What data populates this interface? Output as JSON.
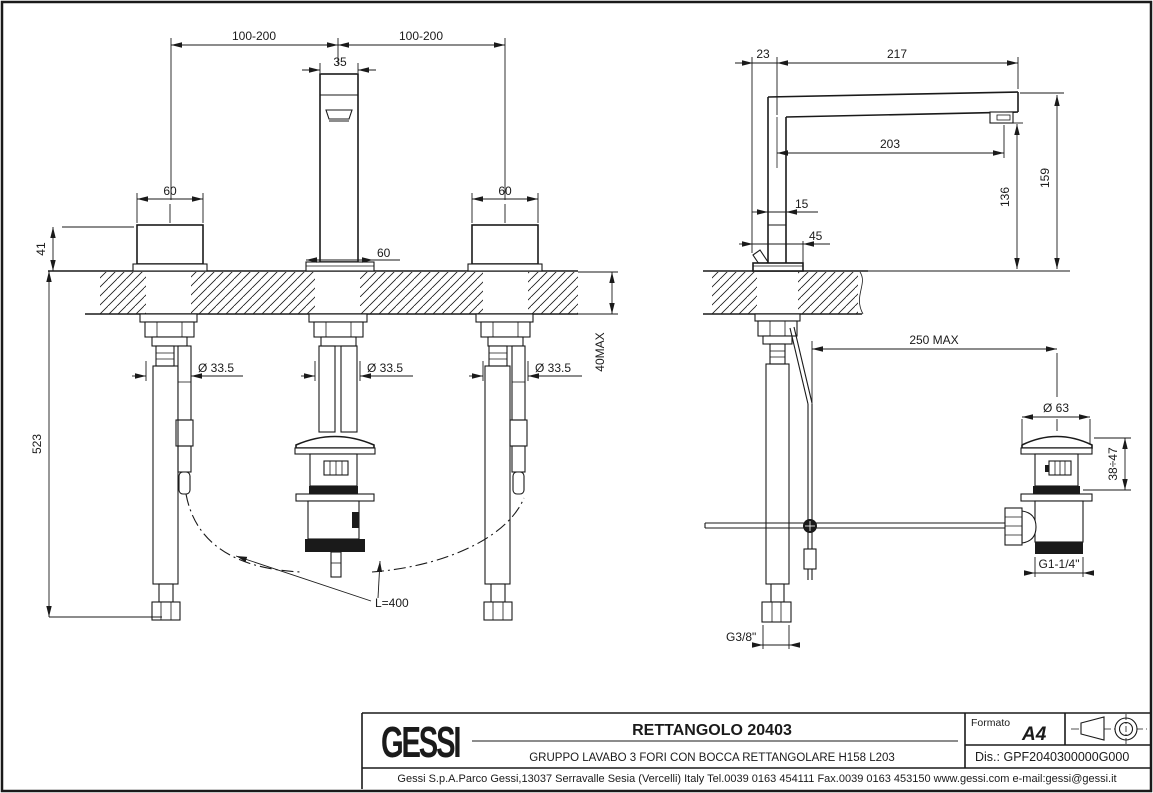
{
  "colors": {
    "ink": "#1a1a1a",
    "paper": "#ffffff"
  },
  "front_view": {
    "dims": {
      "spread_left": "100-200",
      "spread_right": "100-200",
      "spout_width": "35",
      "handle_width_left": "60",
      "handle_width_right": "60",
      "handle_height": "41",
      "spout_base_width": "60",
      "hole_dia_left": "Ø 33.5",
      "hole_dia_center": "Ø 33.5",
      "hole_dia_right": "Ø 33.5",
      "counter_thickness": "40MAX",
      "total_depth": "523",
      "hose_length": "L=400"
    }
  },
  "side_view": {
    "dims": {
      "body_offset": "23",
      "spout_reach_total": "217",
      "spout_reach_aerator": "203",
      "body_width": "15",
      "base_depth": "45",
      "aerator_height": "136",
      "spout_height": "159",
      "drain_rod_reach": "250 MAX",
      "drain_cap_dia": "Ø 63",
      "drain_adjust_range": "38÷47",
      "drain_thread": "G1-1/4\"",
      "supply_thread": "G3/8\""
    }
  },
  "title_block": {
    "brand": "GESSI",
    "product": "RETTANGOLO 20403",
    "description": "GRUPPO LAVABO 3 FORI CON BOCCA RETTANGOLARE H158 L203",
    "format_label": "Formato",
    "format_value": "A4",
    "drawing_code": "Dis.: GPF2040300000G000",
    "company_footer": "Gessi S.p.A.Parco Gessi,13037 Serravalle Sesia (Vercelli) Italy Tel.0039 0163 454111 Fax.0039 0163 453150 www.gessi.com e-mail:gessi@gessi.it"
  }
}
